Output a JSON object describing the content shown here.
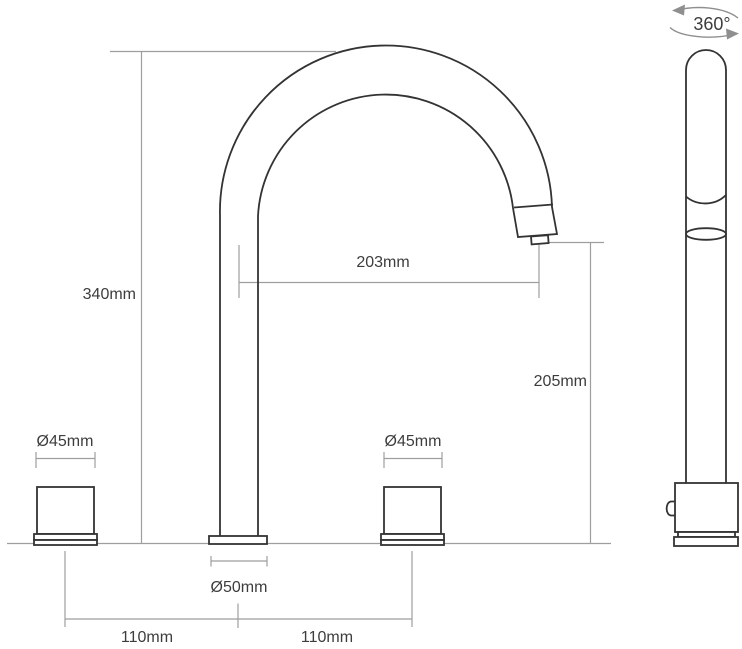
{
  "drawing": {
    "colors": {
      "background": "#ffffff",
      "outline": "#333333",
      "dimension_line": "#9e9e9e",
      "label_text": "#3d3d3d"
    },
    "rotation_label": "360°",
    "dim_overall_height": "340mm",
    "dim_spout_reach": "203mm",
    "dim_spout_clearance": "205mm",
    "dim_handle_left_diameter": "Ø45mm",
    "dim_handle_right_diameter": "Ø45mm",
    "dim_spout_base_diameter": "Ø50mm",
    "dim_spacing_left": "110mm",
    "dim_spacing_right": "110mm"
  }
}
